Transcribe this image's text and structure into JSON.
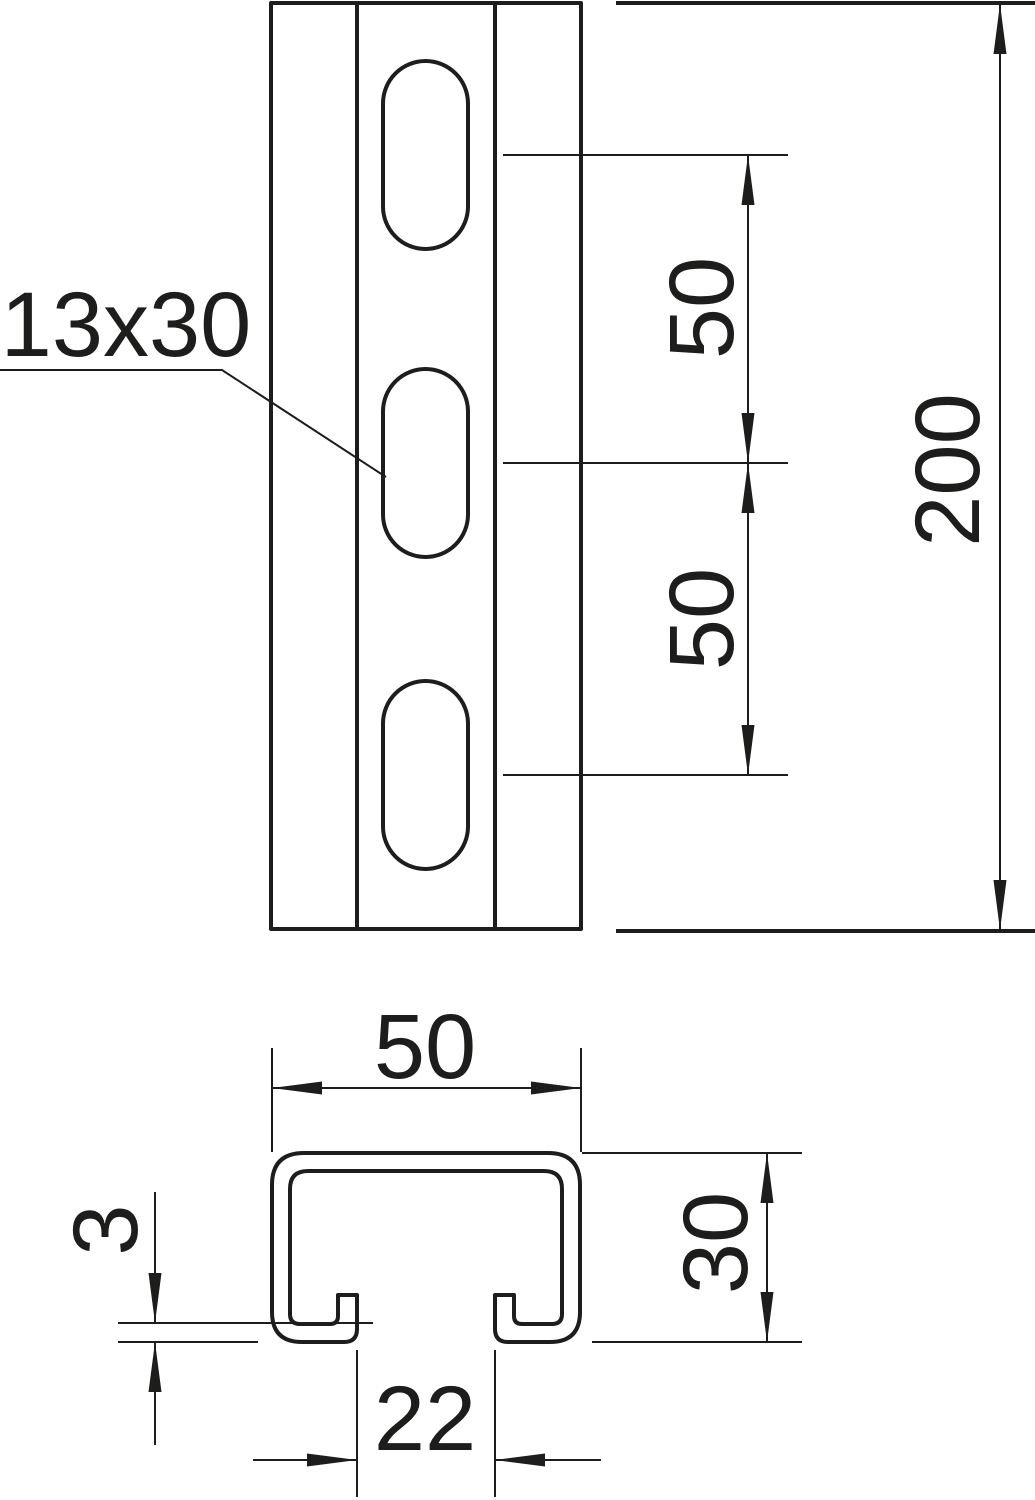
{
  "drawing": {
    "type": "technical-dimension-drawing",
    "background_color": "#ffffff",
    "line_color": "#1d1d1b",
    "front_view": {
      "slot_count": 3,
      "slot_size_label": "13x30",
      "dim_slot_spacing_upper": "50",
      "dim_slot_spacing_lower": "50",
      "dim_total_length": "200"
    },
    "cross_section": {
      "dim_outer_width": "50",
      "dim_profile_height": "30",
      "dim_material_thickness": "3",
      "dim_channel_opening": "22"
    }
  }
}
